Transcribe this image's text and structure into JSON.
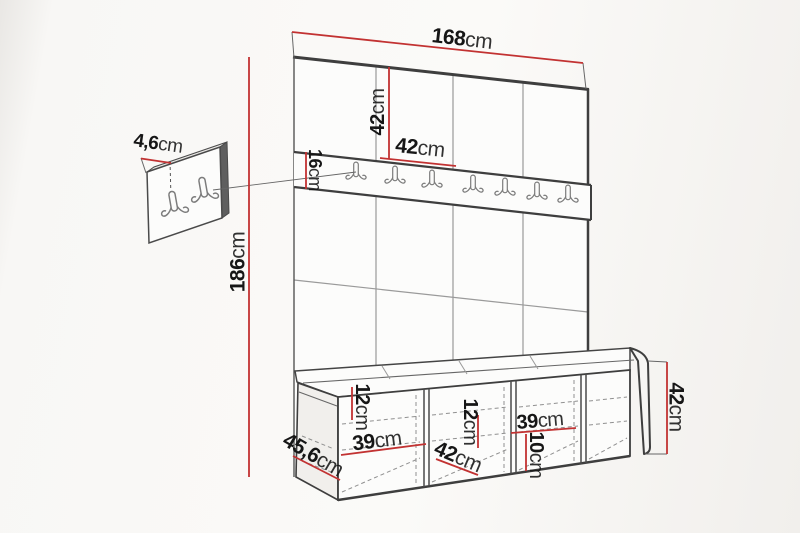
{
  "diagram": {
    "type": "furniture-dimension-drawing",
    "subject": "hallway set: upholstered wall panels with coat hook rail, shoe bench and wall panel detail",
    "unit": "cm",
    "colors": {
      "dimension_line": "#c23232",
      "edge_line": "#3e3e3e",
      "grid_line": "#9a9a9a",
      "hidden_line": "#909090",
      "background": "#f8f7f5",
      "label_text": "#161616"
    },
    "structure": {
      "wall_panel_columns": 4,
      "rail_hook_count": 7,
      "detail_panel_hook_count": 2,
      "bench_compartments": 4,
      "icon": "coat-hook"
    }
  },
  "dimensions": {
    "total_width": {
      "value": "168",
      "unit": "cm"
    },
    "panel_height": {
      "value": "42",
      "unit": "cm"
    },
    "panel_width": {
      "value": "42",
      "unit": "cm"
    },
    "rail_height": {
      "value": "16",
      "unit": "cm"
    },
    "wall_panel_thickness": {
      "value": "4,6",
      "unit": "cm"
    },
    "total_height": {
      "value": "186",
      "unit": "cm"
    },
    "bench_shelf_gap_left": {
      "value": "12",
      "unit": "cm"
    },
    "bench_compartment_width_left": {
      "value": "39",
      "unit": "cm"
    },
    "bench_depth": {
      "value": "45,6",
      "unit": "cm"
    },
    "bench_compartment_depth": {
      "value": "42",
      "unit": "cm"
    },
    "bench_shelf_gap_middle": {
      "value": "12",
      "unit": "cm"
    },
    "bench_compartment_width_right": {
      "value": "39",
      "unit": "cm"
    },
    "bench_shelf_gap_right": {
      "value": "10",
      "unit": "cm"
    },
    "bench_height": {
      "value": "42",
      "unit": "cm"
    }
  }
}
